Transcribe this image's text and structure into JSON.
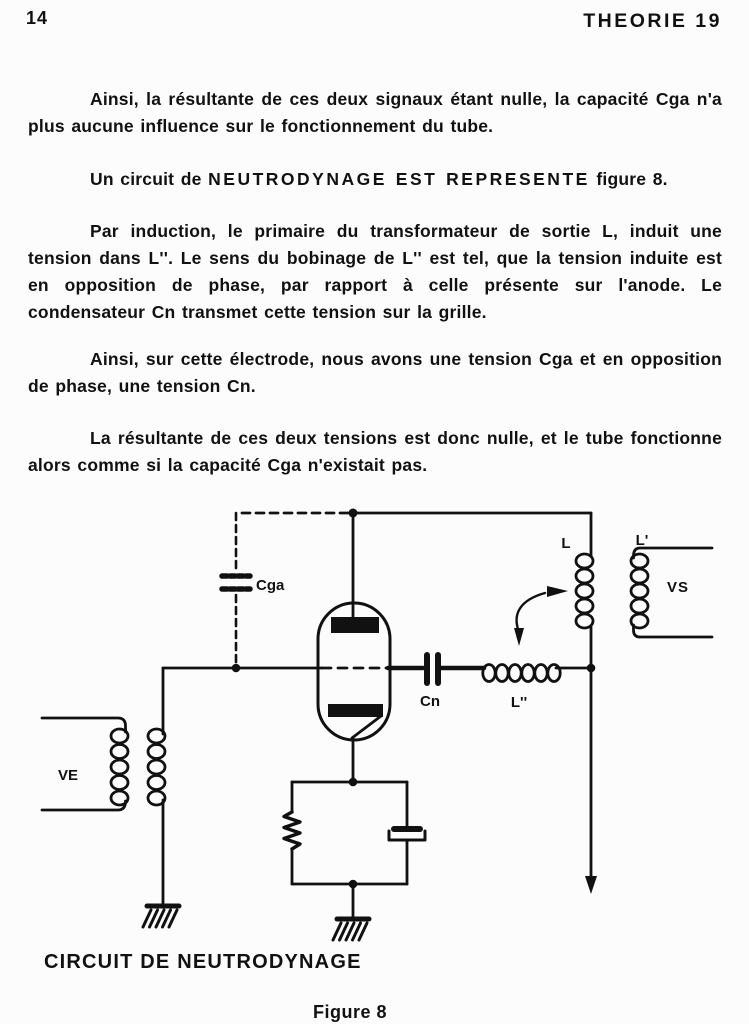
{
  "header": {
    "page_number": "14",
    "title": "THEORIE 19"
  },
  "body": {
    "p1": "Ainsi, la résultante de ces deux signaux étant nulle, la capacité Cga n'a plus aucune influence sur le fonctionnement du tube.",
    "p2_prefix": "Un circuit de ",
    "p2_caps": "NEUTRODYNAGE EST REPRESENTE",
    "p2_suffix": " figure 8.",
    "p3": "Par induction, le primaire du transformateur de sortie L, induit une tension dans L''. Le sens du bobinage de L'' est tel, que la tension induite est en opposition de phase, par rapport à celle présente sur l'anode. Le condensateur Cn transmet cette tension sur la grille.",
    "p4": "Ainsi, sur cette électrode, nous avons une tension Cga et en opposition de phase, une tension Cn.",
    "p5": "La résultante de ces deux tensions est donc nulle, et le tube fonctionne alors comme si la capacité Cga n'existait pas."
  },
  "figure": {
    "labels": {
      "cga": "Cga",
      "cn": "Cn",
      "l": "L",
      "l_prime": "L'",
      "l_double_prime": "L''",
      "vs": "VS",
      "ve": "VE"
    },
    "caption": "CIRCUIT DE NEUTRODYNAGE",
    "figure_label": "Figure 8"
  },
  "colors": {
    "ink": "#111111",
    "paper": "#fcfcfc"
  }
}
